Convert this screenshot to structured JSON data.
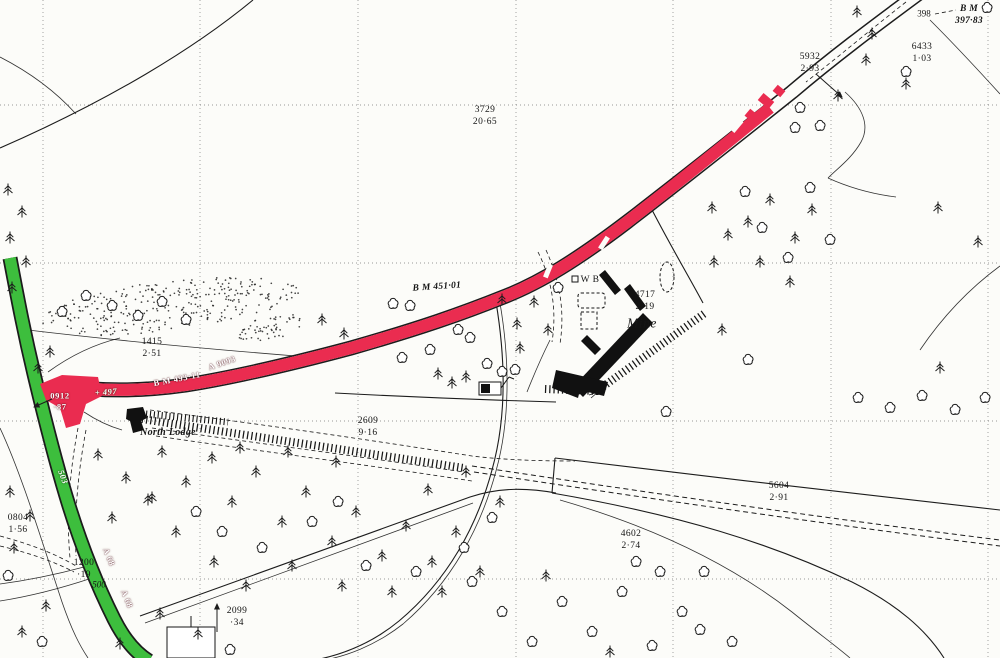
{
  "map_type": "ordnance-survey-plan",
  "palette": {
    "road_a_red": "#ea2c50",
    "road_b_green": "#3dbe3d",
    "paper": "#fcfcf9",
    "ink": "#1c1c1c",
    "grid": "#787878"
  },
  "roads": {
    "primary": {
      "number": "A 9093",
      "color_key": "road_a_red"
    },
    "secondary": {
      "number": "A 68",
      "color_key": "road_b_green"
    }
  },
  "grid": {
    "vertical_x": [
      43,
      200,
      358,
      516,
      673,
      831,
      988
    ],
    "horizontal_y": [
      105,
      263,
      421,
      579
    ]
  },
  "labels": [
    {
      "name": "spot-height-398",
      "cls": "spot",
      "text": "398",
      "x": 924,
      "y": 14,
      "rot": 0
    },
    {
      "name": "benchmark-397-83",
      "cls": "bm",
      "text": "B M\n397·83",
      "x": 969,
      "y": 16,
      "rot": 0
    },
    {
      "name": "parcel-5932",
      "cls": "parcel",
      "text": "5932\n2·93",
      "x": 810,
      "y": 64,
      "rot": 0
    },
    {
      "name": "parcel-6433",
      "cls": "parcel",
      "text": "6433\n1·03",
      "x": 922,
      "y": 54,
      "rot": 0
    },
    {
      "name": "parcel-3729",
      "cls": "parcel",
      "text": "3729\n20·65",
      "x": 485,
      "y": 117,
      "rot": 0
    },
    {
      "name": "benchmark-451-01",
      "cls": "bm",
      "text": "B M 451·01",
      "x": 437,
      "y": 288,
      "rot": -4
    },
    {
      "name": "parcel-1415",
      "cls": "parcel",
      "text": "1415\n2·51",
      "x": 152,
      "y": 349,
      "rot": 0
    },
    {
      "name": "benchmark-493-11",
      "cls": "road-text",
      "text": "B M 493·11",
      "x": 177,
      "y": 379,
      "rot": -11
    },
    {
      "name": "road-number-a9093",
      "cls": "road-text",
      "text": "A 9093",
      "x": 222,
      "y": 363,
      "rot": -19
    },
    {
      "name": "spot-height-497",
      "cls": "road-text-it",
      "text": "+ 497",
      "x": 106,
      "y": 392,
      "rot": -4
    },
    {
      "name": "parcel-0912",
      "cls": "road-text",
      "text": "0912\n·87",
      "x": 60,
      "y": 401,
      "rot": 0
    },
    {
      "name": "place-north-lodge",
      "cls": "place",
      "text": "North Lodge",
      "x": 168,
      "y": 433,
      "rot": 0
    },
    {
      "name": "weighbridge-wb",
      "cls": "parcel",
      "text": "W B",
      "x": 590,
      "y": 281,
      "rot": 0
    },
    {
      "name": "parcel-4717",
      "cls": "parcel",
      "text": "4717\n2·19",
      "x": 645,
      "y": 302,
      "rot": 0
    },
    {
      "name": "place-mine",
      "cls": "place-lg",
      "text": "Mine",
      "x": 642,
      "y": 324,
      "rot": 0
    },
    {
      "name": "parcel-2609",
      "cls": "parcel",
      "text": "2609\n9·16",
      "x": 368,
      "y": 428,
      "rot": 0
    },
    {
      "name": "parcel-5604",
      "cls": "parcel",
      "text": "5604\n2·91",
      "x": 779,
      "y": 493,
      "rot": 0
    },
    {
      "name": "parcel-4602",
      "cls": "parcel",
      "text": "4602\n2·74",
      "x": 631,
      "y": 541,
      "rot": 0
    },
    {
      "name": "parcel-0804",
      "cls": "parcel",
      "text": "0804\n1·56",
      "x": 18,
      "y": 525,
      "rot": 0
    },
    {
      "name": "parcel-1200",
      "cls": "parcel",
      "text": "1200\n·19",
      "x": 84,
      "y": 570,
      "rot": 0
    },
    {
      "name": "spot-height-500",
      "cls": "spot-it",
      "text": "500",
      "x": 99,
      "y": 585,
      "rot": 0
    },
    {
      "name": "parcel-2099",
      "cls": "parcel",
      "text": "2099\n·34",
      "x": 237,
      "y": 618,
      "rot": 0
    },
    {
      "name": "road-number-a68-upper",
      "cls": "road-text",
      "text": "A 68",
      "x": 109,
      "y": 557,
      "rot": 68
    },
    {
      "name": "road-number-a68-lower",
      "cls": "road-text",
      "text": "A 68",
      "x": 127,
      "y": 599,
      "rot": 68
    },
    {
      "name": "spot-height-503",
      "cls": "road-text-it",
      "text": "503",
      "x": 63,
      "y": 477,
      "rot": 68
    }
  ],
  "trees": {
    "conifers": [
      [
        857,
        12
      ],
      [
        872,
        34
      ],
      [
        866,
        60
      ],
      [
        906,
        84
      ],
      [
        838,
        96
      ],
      [
        712,
        208
      ],
      [
        728,
        235
      ],
      [
        714,
        262
      ],
      [
        748,
        222
      ],
      [
        770,
        200
      ],
      [
        795,
        238
      ],
      [
        812,
        210
      ],
      [
        760,
        262
      ],
      [
        790,
        282
      ],
      [
        938,
        208
      ],
      [
        978,
        242
      ],
      [
        940,
        368
      ],
      [
        722,
        330
      ],
      [
        502,
        300
      ],
      [
        517,
        324
      ],
      [
        534,
        302
      ],
      [
        548,
        330
      ],
      [
        520,
        348
      ],
      [
        322,
        320
      ],
      [
        344,
        334
      ],
      [
        438,
        374
      ],
      [
        452,
        383
      ],
      [
        466,
        377
      ],
      [
        162,
        452
      ],
      [
        186,
        482
      ],
      [
        212,
        458
      ],
      [
        232,
        502
      ],
      [
        256,
        472
      ],
      [
        282,
        522
      ],
      [
        306,
        492
      ],
      [
        332,
        542
      ],
      [
        356,
        512
      ],
      [
        382,
        556
      ],
      [
        406,
        526
      ],
      [
        432,
        562
      ],
      [
        456,
        532
      ],
      [
        480,
        572
      ],
      [
        214,
        562
      ],
      [
        176,
        532
      ],
      [
        246,
        586
      ],
      [
        292,
        566
      ],
      [
        342,
        586
      ],
      [
        392,
        592
      ],
      [
        442,
        592
      ],
      [
        466,
        472
      ],
      [
        500,
        502
      ],
      [
        152,
        498
      ],
      [
        240,
        448
      ],
      [
        288,
        452
      ],
      [
        336,
        462
      ],
      [
        428,
        490
      ],
      [
        546,
        576
      ],
      [
        10,
        492
      ],
      [
        30,
        516
      ],
      [
        14,
        548
      ],
      [
        46,
        606
      ],
      [
        22,
        632
      ],
      [
        120,
        644
      ],
      [
        8,
        190
      ],
      [
        22,
        212
      ],
      [
        10,
        238
      ],
      [
        26,
        262
      ],
      [
        12,
        288
      ],
      [
        50,
        352
      ],
      [
        38,
        368
      ],
      [
        98,
        455
      ],
      [
        126,
        478
      ],
      [
        148,
        500
      ],
      [
        112,
        518
      ],
      [
        160,
        614
      ],
      [
        198,
        634
      ],
      [
        610,
        652
      ]
    ],
    "deciduous": [
      [
        987,
        8
      ],
      [
        800,
        108
      ],
      [
        820,
        126
      ],
      [
        795,
        128
      ],
      [
        745,
        192
      ],
      [
        762,
        228
      ],
      [
        788,
        258
      ],
      [
        810,
        188
      ],
      [
        830,
        240
      ],
      [
        858,
        398
      ],
      [
        890,
        408
      ],
      [
        922,
        396
      ],
      [
        955,
        410
      ],
      [
        985,
        398
      ],
      [
        748,
        360
      ],
      [
        558,
        288
      ],
      [
        393,
        304
      ],
      [
        410,
        306
      ],
      [
        402,
        358
      ],
      [
        430,
        350
      ],
      [
        458,
        330
      ],
      [
        470,
        338
      ],
      [
        487,
        364
      ],
      [
        502,
        372
      ],
      [
        515,
        370
      ],
      [
        196,
        512
      ],
      [
        262,
        548
      ],
      [
        312,
        522
      ],
      [
        366,
        566
      ],
      [
        416,
        572
      ],
      [
        464,
        548
      ],
      [
        492,
        518
      ],
      [
        222,
        532
      ],
      [
        338,
        502
      ],
      [
        472,
        582
      ],
      [
        502,
        612
      ],
      [
        532,
        642
      ],
      [
        562,
        602
      ],
      [
        592,
        632
      ],
      [
        622,
        592
      ],
      [
        652,
        646
      ],
      [
        682,
        612
      ],
      [
        704,
        572
      ],
      [
        732,
        642
      ],
      [
        660,
        572
      ],
      [
        636,
        562
      ],
      [
        700,
        630
      ],
      [
        86,
        296
      ],
      [
        112,
        306
      ],
      [
        138,
        316
      ],
      [
        162,
        302
      ],
      [
        186,
        320
      ],
      [
        62,
        312
      ],
      [
        8,
        576
      ],
      [
        42,
        642
      ],
      [
        230,
        650
      ],
      [
        906,
        72
      ],
      [
        666,
        412
      ]
    ]
  },
  "scrub_regions": [
    {
      "cx": 168,
      "cy": 306,
      "rx": 132,
      "ry": 25,
      "rot": -7,
      "dots": 300
    },
    {
      "cx": 272,
      "cy": 327,
      "rx": 38,
      "ry": 12,
      "rot": -10,
      "dots": 55
    }
  ]
}
